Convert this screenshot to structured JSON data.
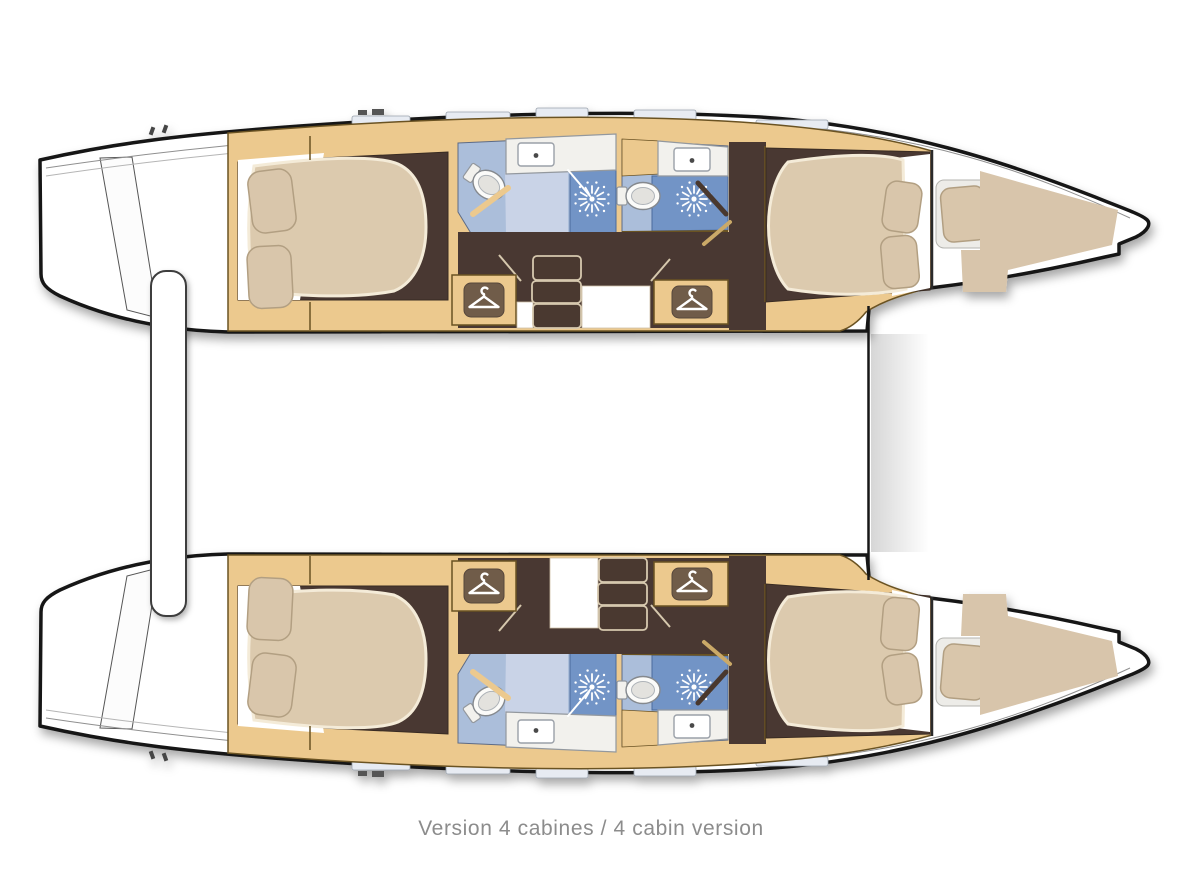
{
  "caption": {
    "text": "Version 4 cabines / 4 cabin version"
  },
  "colors": {
    "outline": "#161616",
    "hull_fill": "#ffffff",
    "wood": "#ecc98e",
    "wood_dark": "#e3bd7f",
    "wood_line": "#6b5224",
    "floor": "#4a3930",
    "floor_light": "#5a463b",
    "bed": "#dccaae",
    "bed_edge": "#f4ebd8",
    "pillow": "#d9c6ab",
    "pillow_line": "#b29f82",
    "sheet": "#ffffff",
    "bath_floor": "#abbeda",
    "bath_panel": "#c9d3e7",
    "shower": "#7294c6",
    "fixture": "#f2f1ed",
    "fixture_line": "#93989e",
    "bow_deck": "#d8c5ab",
    "berth_pad": "#edece8",
    "icon_bg": "#6f5b49",
    "step_line": "#d6c8ae",
    "caption": "#8c8c8c"
  },
  "icons": {
    "hanger-icon": "clothes hanger (wardrobe)",
    "shower-spray-icon": "shower spray starburst",
    "toilet-icon": "toilet",
    "sink-icon": "washbasin with drain dot",
    "cleat-icon": "deck cleat",
    "deck-hatch": "deck hatch"
  }
}
